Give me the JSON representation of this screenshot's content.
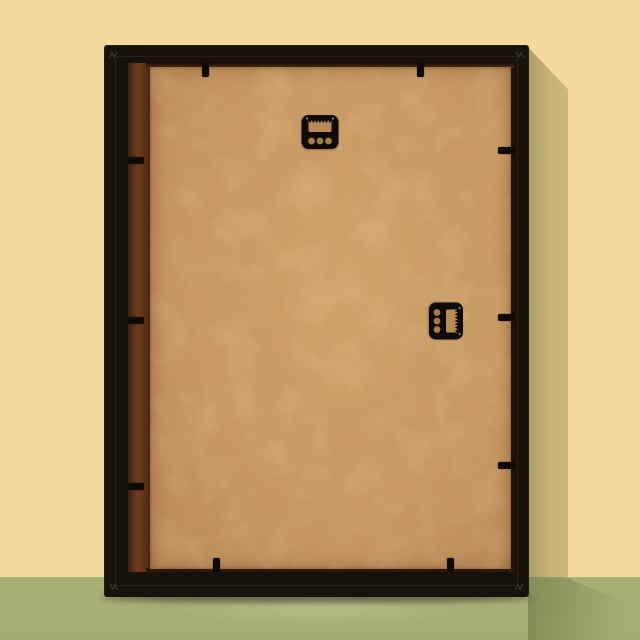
{
  "scene": {
    "description": "Back of a black picture frame with a tan hardboard backing panel, leaning against a pale yellow wall on a sage green floor; cast shadow falls to the right and a soft reflection appears on the floor below",
    "colors": {
      "wall": "#f5d99e",
      "wall_shadow": "#c6b176",
      "wall_shadow_dark": "#b19d65",
      "floor": "#a9b077",
      "floor_shadow": "#8d9b62",
      "frame": "#17110c",
      "backing_board": "#c99a63",
      "board_light": "#d2a56c",
      "board_dark": "#b98a55",
      "recess_brown": "#6e3c1e",
      "recess_dark": "#220f05",
      "hardware_black": "#0e0a07"
    },
    "objects": {
      "frame": "black picture frame, rear view, standing on floor",
      "backing_board": "tan MDF hardboard backing panel",
      "top_hanger": "sawtooth hanger plate, horizontal, teeth along window top, three holes below",
      "side_hanger": "sawtooth hanger plate, rotated 90 degrees, holes left, toothed window right",
      "retainer_clips": "small black flexi clips holding backing board",
      "retainer_clip_count": 10,
      "corner_joints": "v-nail joint marks at mitred frame corners"
    }
  }
}
